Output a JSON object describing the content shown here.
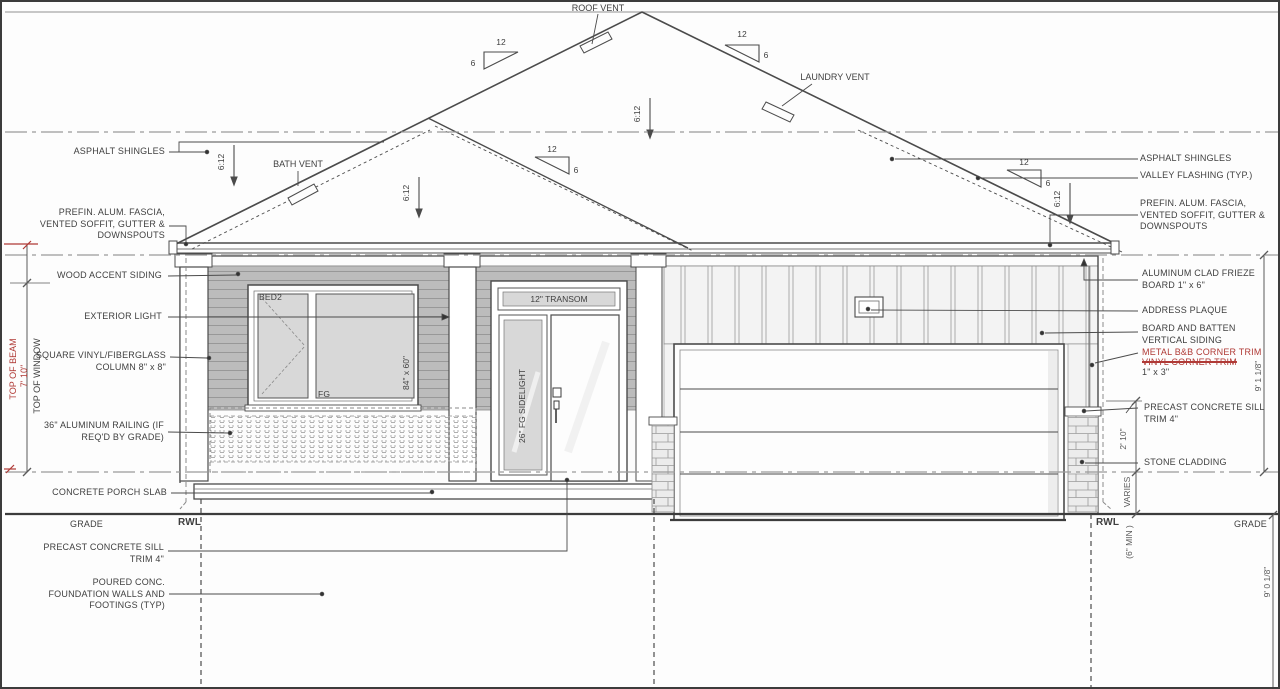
{
  "colors": {
    "line": "#4b4b4b",
    "reference_line": "#9a9a9a",
    "revision_red": "#b03a36",
    "siding_gray": "#bcbcbc",
    "glass_gray": "#d8d8d8",
    "stone_gray": "#ececec"
  },
  "roof": {
    "ratio": "6:12",
    "run": "12",
    "rise": "6",
    "roof_vent": "ROOF VENT",
    "bath_vent": "BATH VENT",
    "laundry_vent": "LAUNDRY VENT"
  },
  "annotations": {
    "left": [
      "ASPHALT SHINGLES",
      "PREFIN. ALUM. FASCIA,\nVENTED SOFFIT, GUTTER &\nDOWNSPOUTS",
      "WOOD ACCENT SIDING",
      "EXTERIOR LIGHT",
      "SQUARE VINYL/FIBERGLASS\nCOLUMN 8\" x 8\"",
      "36\" ALUMINUM RAILING (IF\nREQ'D BY GRADE)",
      "CONCRETE PORCH SLAB",
      "PRECAST CONCRETE SILL\nTRIM 4\"",
      "POURED CONC.\nFOUNDATION WALLS AND\nFOOTINGS (TYP)"
    ],
    "right": [
      "ASPHALT SHINGLES",
      "VALLEY FLASHING (TYP.)",
      "PREFIN. ALUM. FASCIA,\nVENTED SOFFIT, GUTTER &\nDOWNSPOUTS",
      "ALUMINUM CLAD FRIEZE\nBOARD 1\" x 6\"",
      "ADDRESS PLAQUE",
      "BOARD AND BATTEN\nVERTICAL SIDING",
      "PRECAST CONCRETE SILL\nTRIM 4\"",
      "STONE CLADDING"
    ],
    "revision": {
      "new": "METAL B&B CORNER TRIM",
      "old": "VINYL CORNER TRIM",
      "size": "1\" x 3\""
    }
  },
  "site": {
    "grade": "GRADE",
    "rwl": "RWL"
  },
  "dimensions": {
    "top_of_beam": "TOP OF BEAM",
    "beam_height": "7' 10\"",
    "top_of_window": "TOP OF WINDOW",
    "wall_height": "9' 1 1/8\"",
    "foundation_depth": "9' 0 1/8\"",
    "sill_height": "2' 10\"",
    "varies": "VARIES",
    "min_clearance": "(6\" MIN )"
  },
  "openings": {
    "bedroom_window_room": "BED2",
    "bedroom_window_glazing": "FG",
    "bedroom_window_size": "84\" x 60\"",
    "entry_transom": "12\" TRANSOM",
    "entry_sidelight": "26\" FG SIDELIGHT"
  }
}
